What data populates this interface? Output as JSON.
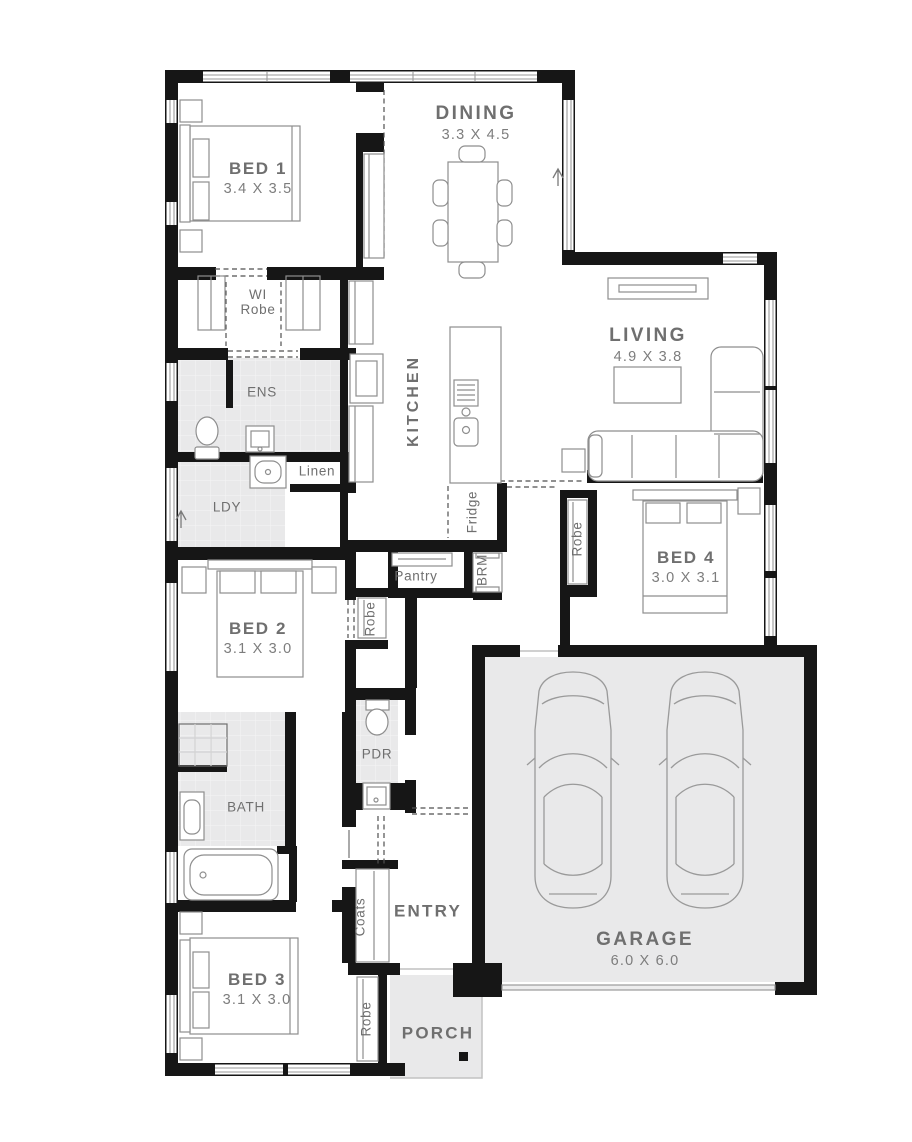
{
  "plan_type": "single-storey house floor plan",
  "colors": {
    "wall": "#161616",
    "shaded_room": "#e9e9ea",
    "tile_line": "#f3f3f4",
    "label": "#6f6f6f",
    "dimension": "#7d7d7d",
    "furniture_outline": "#8e8e8e",
    "window_line": "#9a9a9a"
  },
  "rooms": {
    "bed1": {
      "name": "BED 1",
      "size": "3.4 X 3.5"
    },
    "dining": {
      "name": "DINING",
      "size": "3.3 X 4.5"
    },
    "wi_robe": {
      "line1": "WI",
      "line2": "Robe"
    },
    "ens": {
      "name": "ENS"
    },
    "linen": {
      "name": "Linen"
    },
    "ldy": {
      "name": "LDY"
    },
    "kitchen": {
      "name": "KITCHEN"
    },
    "living": {
      "name": "LIVING",
      "size": "4.9 X 3.8"
    },
    "fridge": {
      "name": "Fridge"
    },
    "pantry": {
      "name": "Pantry"
    },
    "brm": {
      "name": "BRM"
    },
    "bed4": {
      "name": "BED 4",
      "size": "3.0 X 3.1"
    },
    "robe_bed4": {
      "name": "Robe"
    },
    "bed2": {
      "name": "BED 2",
      "size": "3.1 X 3.0"
    },
    "robe_bed2": {
      "name": "Robe"
    },
    "pdr": {
      "name": "PDR"
    },
    "bath": {
      "name": "BATH"
    },
    "entry": {
      "name": "ENTRY"
    },
    "coats": {
      "name": "Coats"
    },
    "garage": {
      "name": "GARAGE",
      "size": "6.0 X 6.0"
    },
    "bed3": {
      "name": "BED 3",
      "size": "3.1 X 3.0"
    },
    "robe_bed3": {
      "name": "Robe"
    },
    "porch": {
      "name": "PORCH"
    }
  }
}
